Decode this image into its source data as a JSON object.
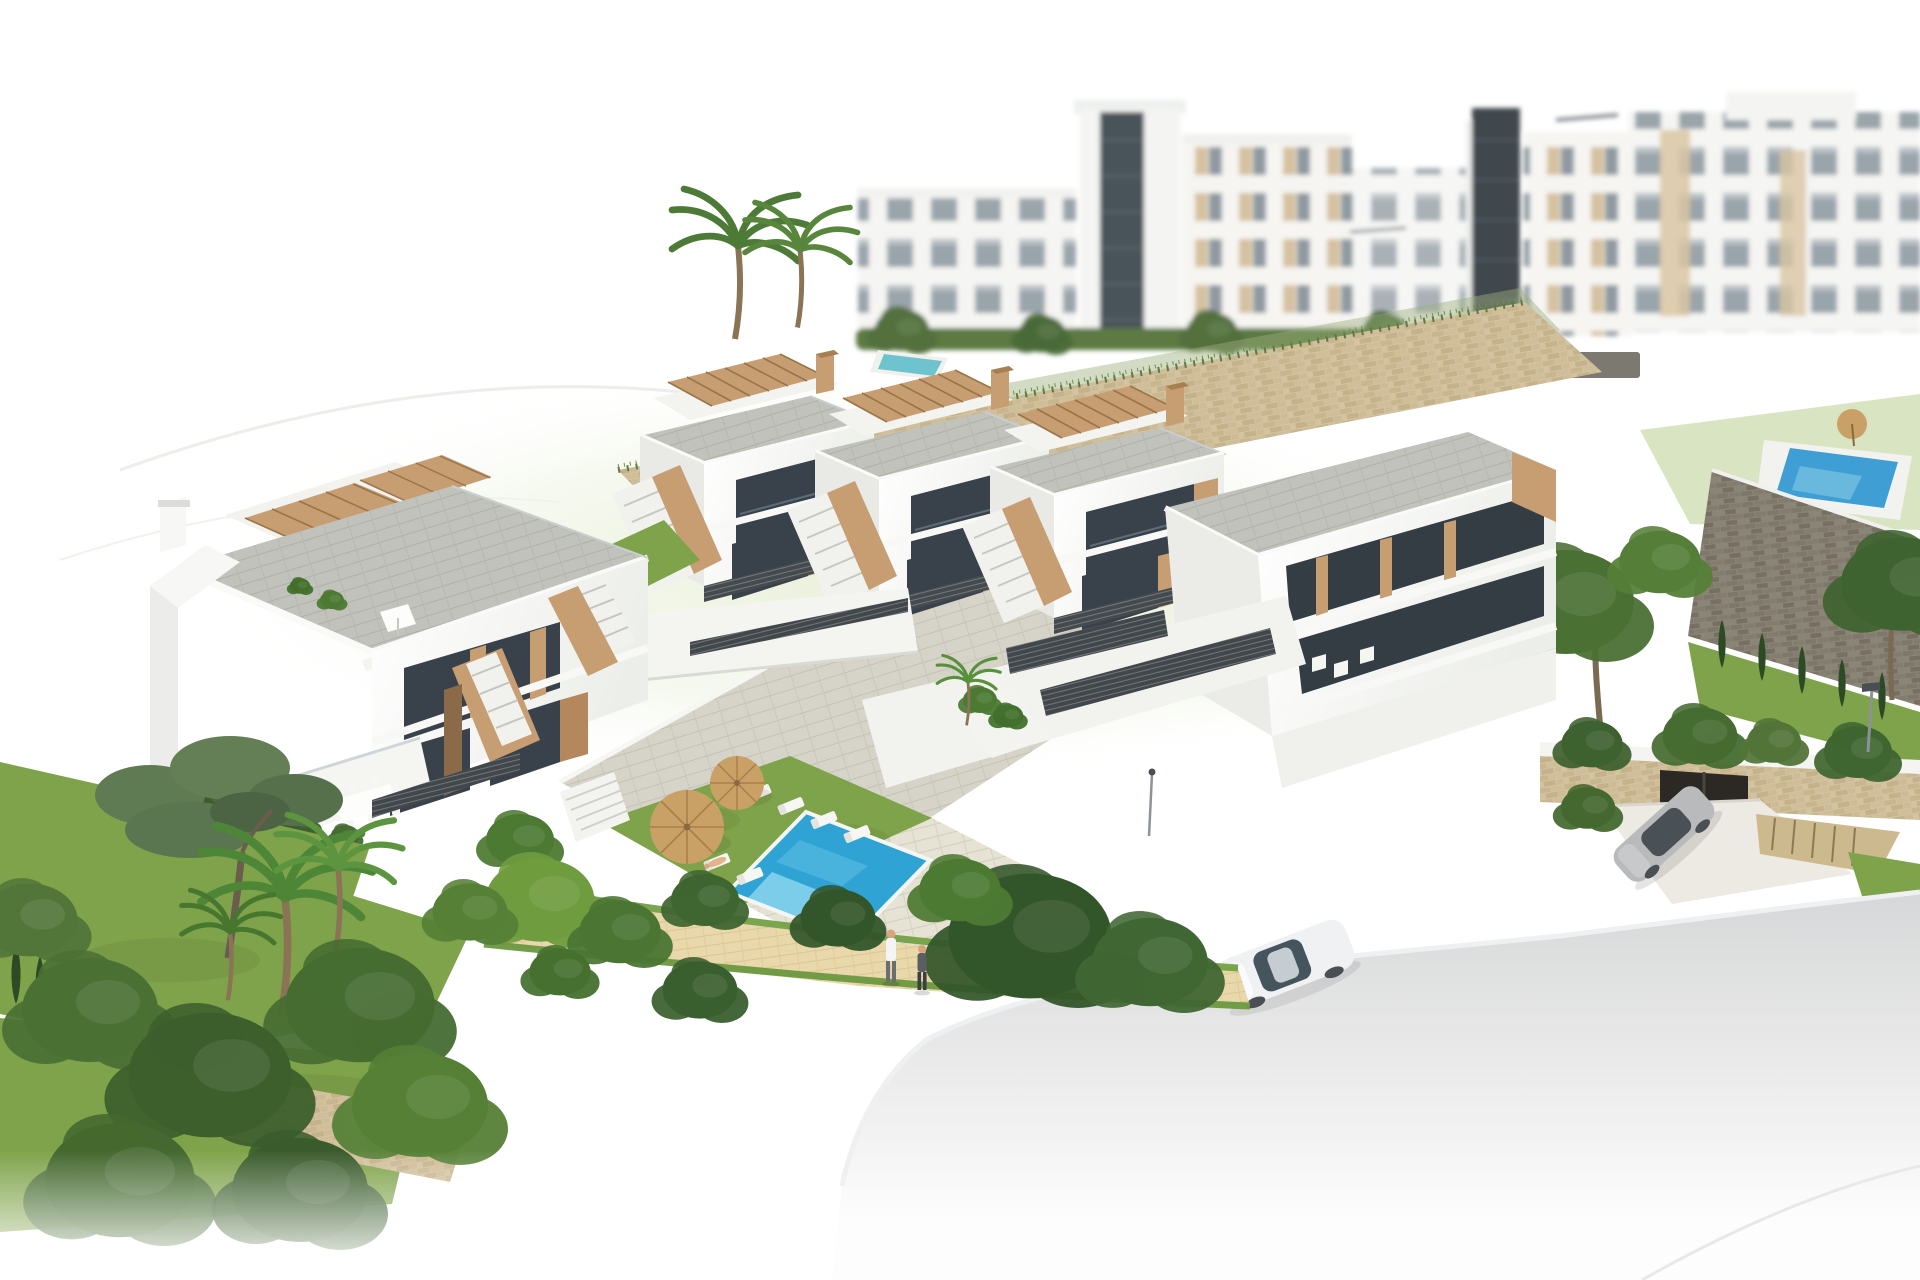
{
  "scene": {
    "kind": "architectural-3d-render",
    "view": "aerial three-quarter view, white studio background",
    "description": "Computer-generated aerial rendering of a hillside residential development: a front row of white townhouses with grey roof terraces, wooden pergolas and external staircases, a second detached block at the left, a communal garden with lawn, swimming pool, sun loungers and two parasols, beige and grey stone retaining walls, blurred white apartment blocks behind, landscaped gardens with palms, pines and cypresses, a sandy footpath with two pedestrians and a curving light-grey road with a white car, plus a silver car on a driveway by a stone carport.",
    "counts": {
      "front_row_townhouse_units": 4,
      "left_block_units": 2,
      "sun_loungers": 7,
      "parasols": 2,
      "pedestrians": 2,
      "sunbathers": 1,
      "cars": 2,
      "foreground_pools": 1,
      "background_pools": 2,
      "street_lamps": 2
    }
  },
  "palette": {
    "background": "#ffffff",
    "hill_wash": "#e9f0da",
    "building_white": "#f6f6f4",
    "building_shade": "#e9e9e6",
    "roof_tile_gray": "#bfc1ba",
    "wood_tan": "#c79d72",
    "door_brown": "#b4875c",
    "window_dark": "#39424a",
    "stone_beige": "#d2c2a0",
    "stone_gray": "#878173",
    "fence_dark": "#42474b",
    "lawn_green": "#7fa34a",
    "tree_dark": "#3a5c2c",
    "tree_light": "#6f9c3e",
    "pool_blue": "#2fa3d4",
    "pool_light": "#8ed7ee",
    "deck_pale": "#e6e2d4",
    "path_sand": "#e9d8ab",
    "road_gray": "#d7d8d9",
    "car_white": "#f0f1f3",
    "car_silver": "#b9babc",
    "parasol_tan": "#c9a166",
    "metal_gray": "#8d9297",
    "trunk_brown": "#7a6a52",
    "skin": "#d9a57e"
  }
}
